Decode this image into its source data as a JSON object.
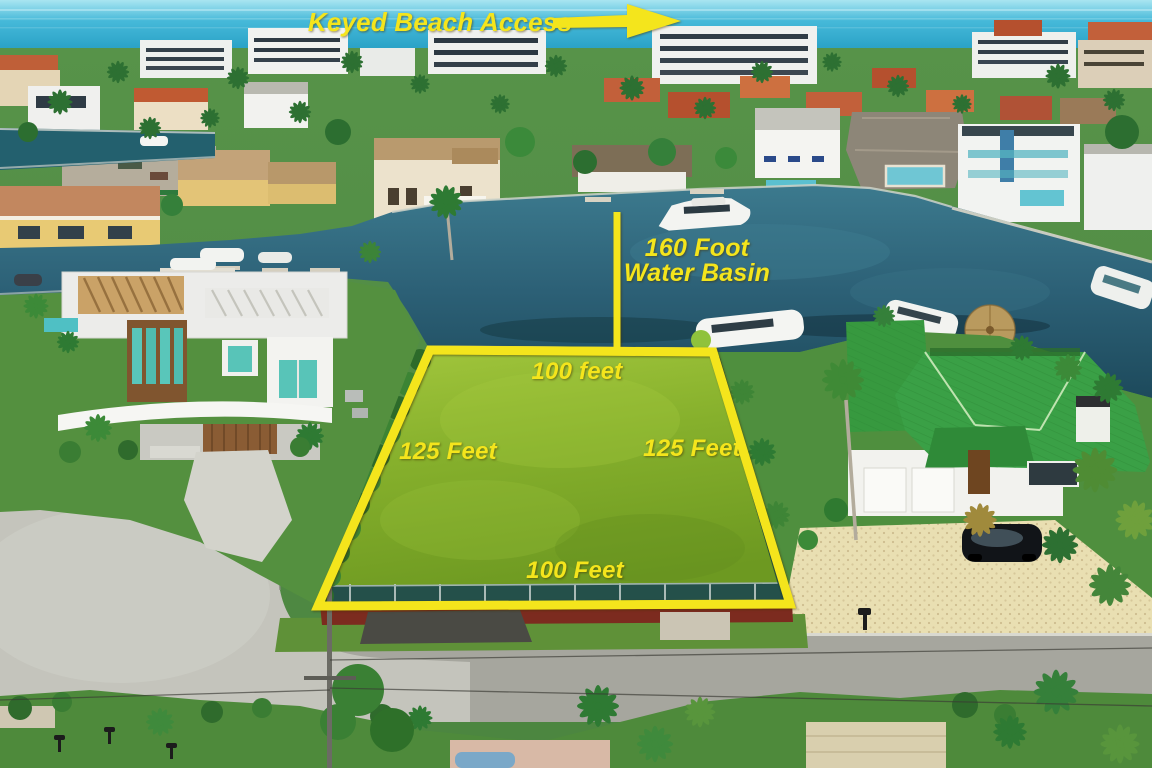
{
  "annotations": {
    "color": "#f4e51c",
    "beach_access_label": "Keyed Beach Access",
    "basin_label_line1": "160 Foot",
    "basin_label_line2": "Water Basin",
    "lot_top_label": "100 feet",
    "lot_left_label": "125 Feet",
    "lot_right_label": "125 Feet",
    "lot_bottom_label": "100 Feet"
  },
  "scene": {
    "ocean_color": "#36aed2",
    "basin_water_color": "#24586a",
    "lot_grass_color": "#84ad2b",
    "green_roof_color": "#3aa046",
    "road_color": "#a6a69e"
  }
}
